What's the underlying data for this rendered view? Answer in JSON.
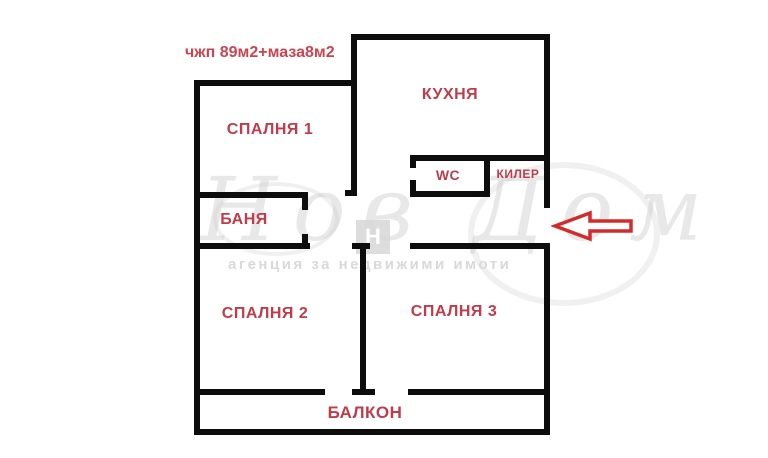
{
  "plan": {
    "annotation": "чжп 89м2+маза8м2",
    "rooms": {
      "kitchen": "КУХНЯ",
      "bedroom1": "СПАЛНЯ 1",
      "wc": "WC",
      "closet": "КИЛЕР",
      "bathroom": "БАНЯ",
      "bedroom2": "СПАЛНЯ 2",
      "bedroom3": "СПАЛНЯ 3",
      "balcony": "БАЛКОН"
    }
  },
  "watermark": {
    "brand_script": "Нов Дом",
    "logo_letter": "Н",
    "tagline": "агенция за недвижими имоти"
  },
  "colors": {
    "room_label": "#c03c4a",
    "annotation": "#cb4450",
    "wall": "#0d0d0d",
    "arrow_outline": "#d32b2b",
    "watermark_gray": "#d9d9d9"
  }
}
